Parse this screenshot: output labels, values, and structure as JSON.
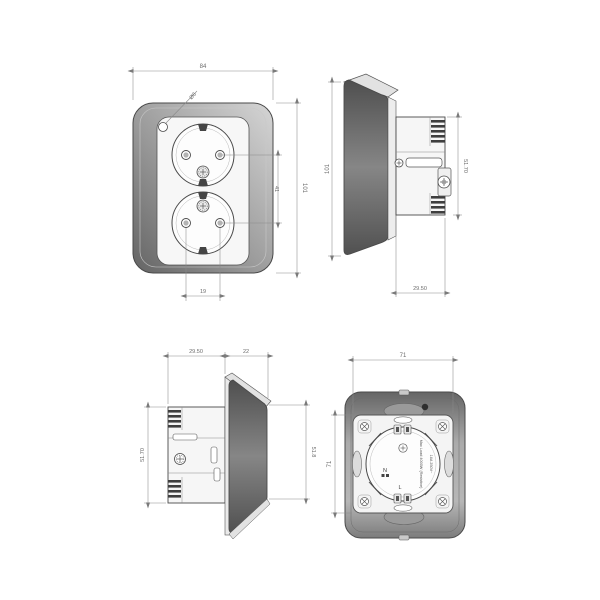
{
  "drawing": {
    "type": "technical-drawing",
    "subject": "double-schuko-wall-socket",
    "views": {
      "front": {
        "dim_width": "84",
        "dim_height": "101",
        "dim_socket_spacing": "41",
        "dim_pin_spacing": "19",
        "indicator_label": "Ø6"
      },
      "side_right": {
        "dim_height": "101",
        "dim_mech_height": "51.70",
        "dim_mech_depth": "29.50"
      },
      "side_left": {
        "dim_mech_depth": "29.50",
        "dim_plate_depth": "22",
        "dim_mech_height": "51.70",
        "dim_face_height": "51.8"
      },
      "rear": {
        "dim_width": "71",
        "dim_height": "71",
        "terminal_n": "N",
        "terminal_l": "L",
        "rating_line1": "Max Load 4000W (Resistive)",
        "rating_line2": "16A 250V~"
      }
    },
    "colors": {
      "line": "#4a4a4a",
      "dim_line": "#8a8a8a",
      "plate_dark": "#5d5d5d",
      "plate_light": "#d4d4d4",
      "face": "#f6f6f6"
    }
  }
}
